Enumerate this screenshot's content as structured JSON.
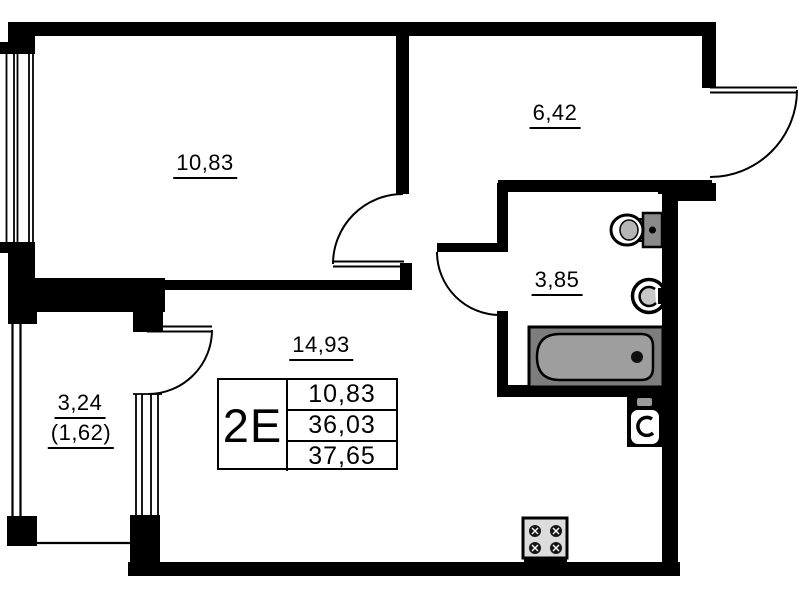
{
  "rooms": {
    "top_room_area": "10,83",
    "hallway_area": "6,42",
    "bathroom_area": "3,85",
    "living_area": "14,93",
    "balcony_area": "3,24",
    "balcony_area_coeff": "(1,62)"
  },
  "info_table": {
    "unit_type": "2E",
    "rows": [
      "10,83",
      "36,03",
      "37,65"
    ]
  },
  "colors": {
    "wall": "#000000",
    "background": "#ffffff",
    "bathtub_outer": "#7d7d7d",
    "bathtub_inner": "#9e9e9e"
  },
  "fixtures": [
    "toilet",
    "washbasin",
    "bathtub",
    "sink-unit",
    "stove"
  ]
}
